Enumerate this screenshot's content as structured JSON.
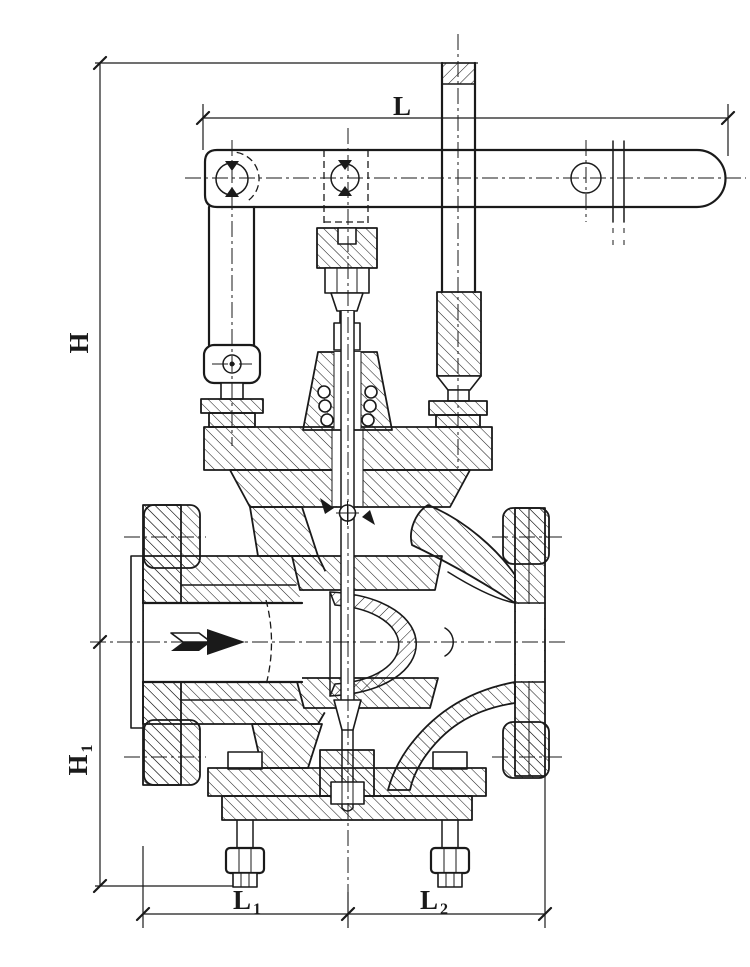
{
  "page": {
    "background": "#ffffff",
    "ink": "#1a1a1a"
  },
  "labels": {
    "L": {
      "base": "L",
      "sub": ""
    },
    "H": {
      "base": "H",
      "sub": ""
    },
    "H1": {
      "base": "H",
      "sub": "1"
    },
    "L1": {
      "base": "L",
      "sub": "1"
    },
    "L2": {
      "base": "L",
      "sub": "2"
    }
  },
  "icons": {
    "flow_arrow": "➤"
  }
}
